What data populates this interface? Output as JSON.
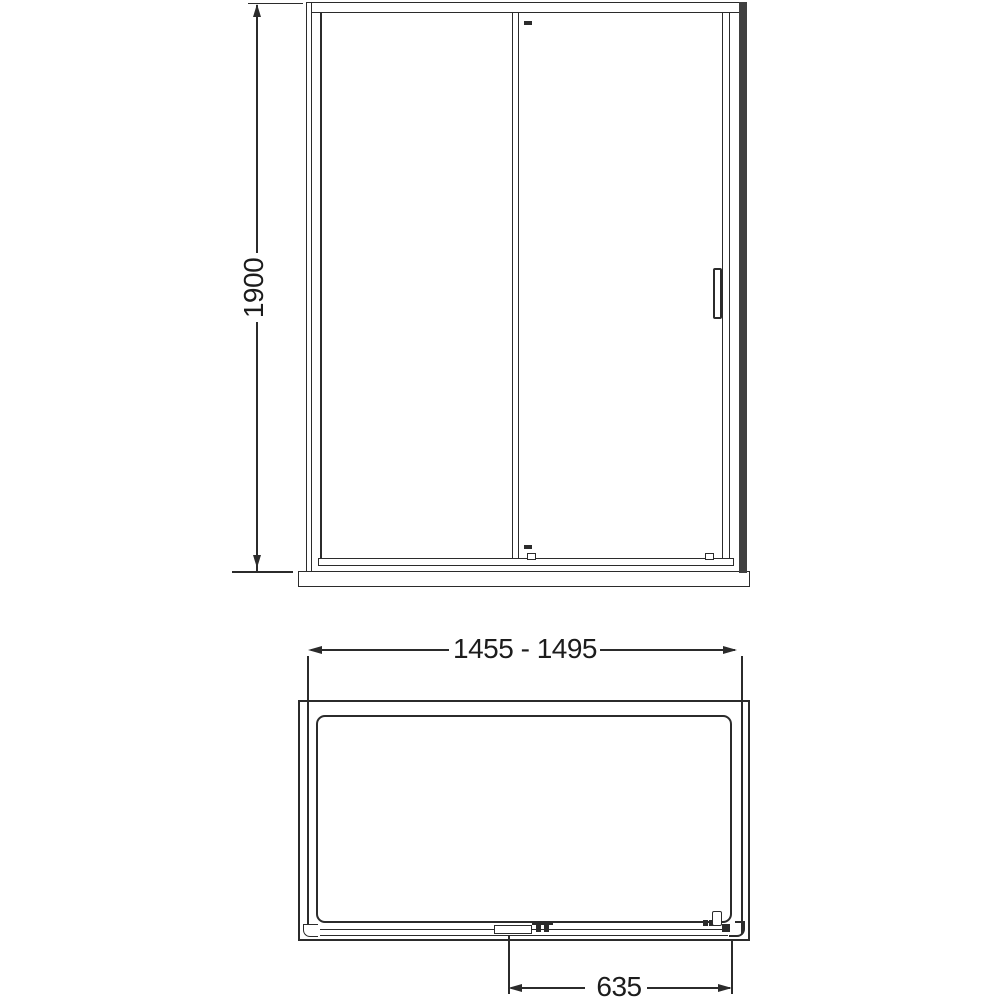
{
  "colors": {
    "line": "#2b2b2b",
    "wall_profile": "#404040",
    "background": "#ffffff"
  },
  "dims": {
    "height": "1900",
    "width_range": "1455 - 1495",
    "opening": "635"
  }
}
